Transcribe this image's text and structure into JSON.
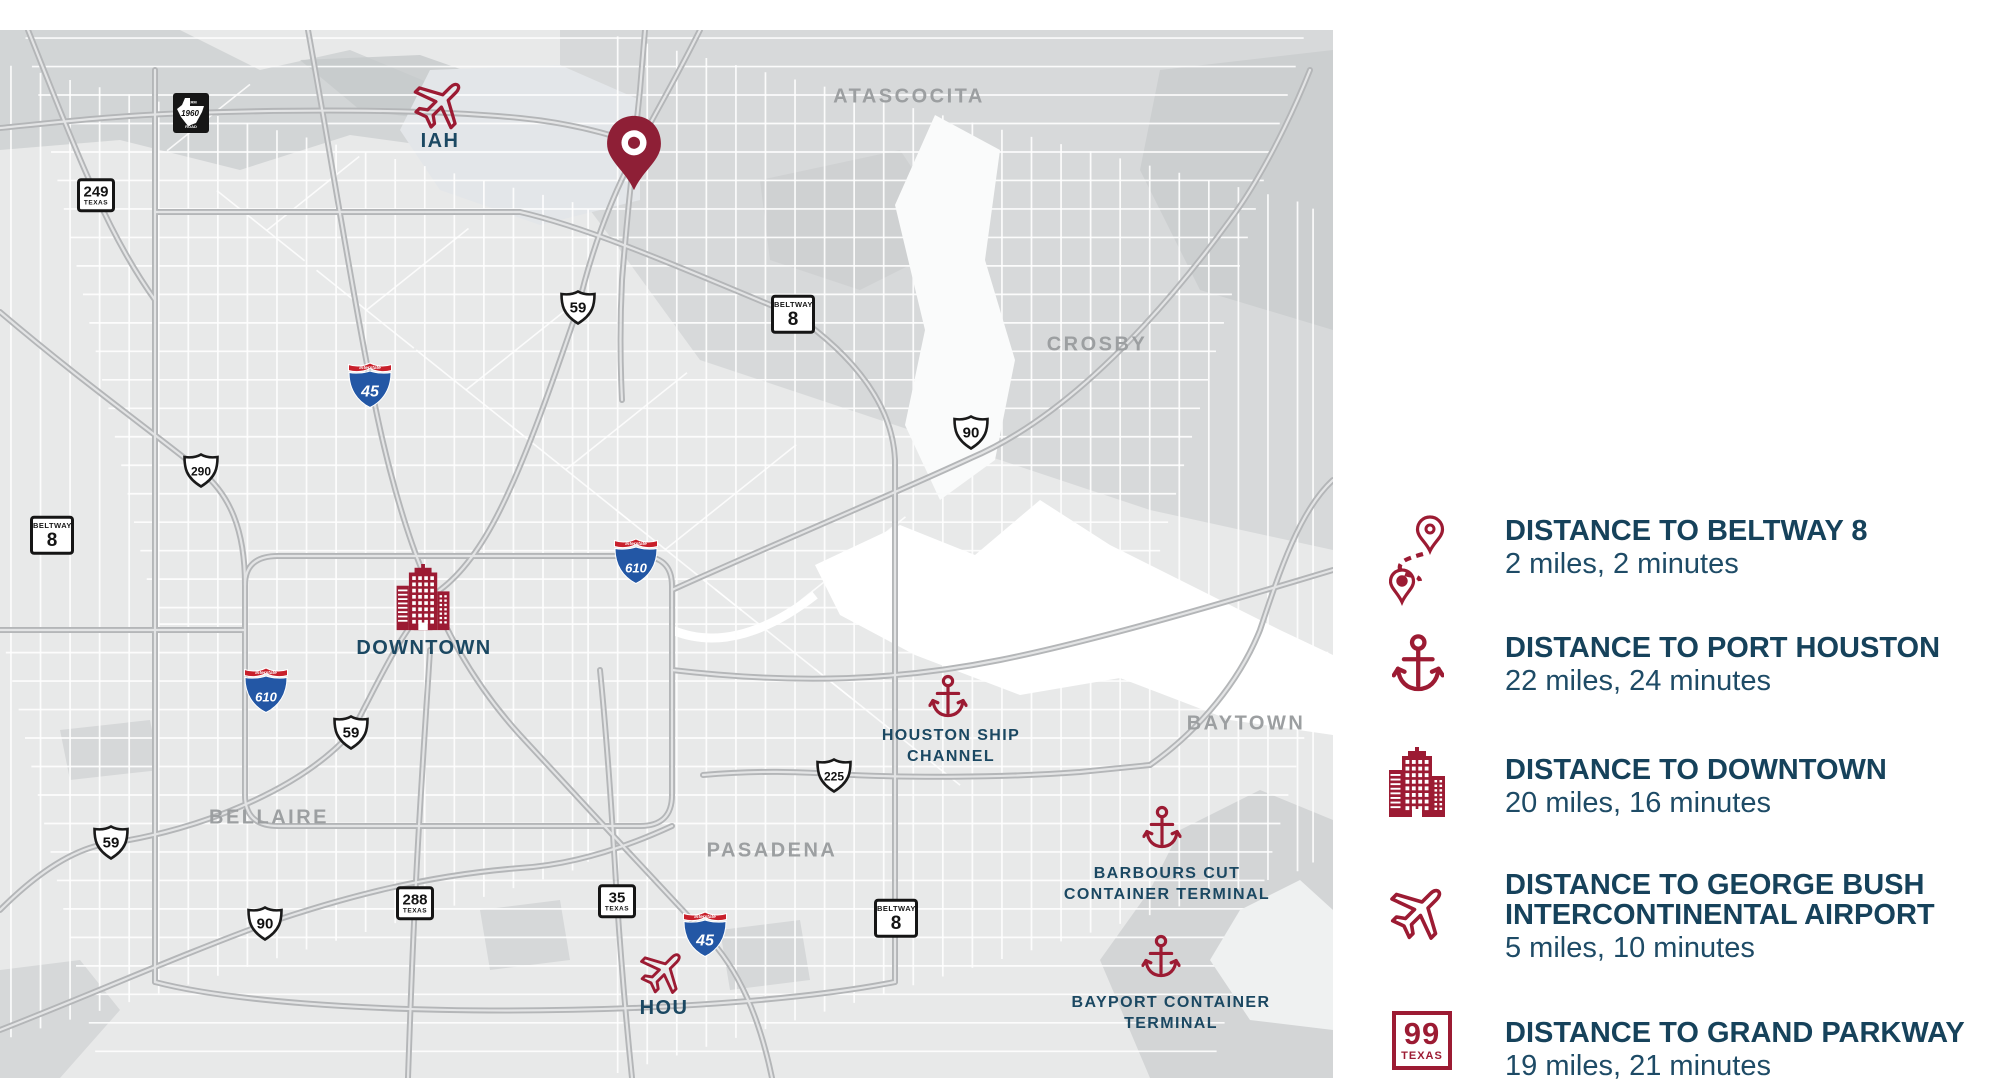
{
  "colors": {
    "brand_red": "#9c1b33",
    "pin_red": "#8e1f36",
    "heading_navy": "#16425b",
    "body_navy": "#1e4b66",
    "poi_navy": "#1b4862",
    "city_gray": "#9c9fa1",
    "interstate_blue": "#2357a5",
    "interstate_red": "#c8202b",
    "map_bg": "#e8e9e9"
  },
  "map": {
    "city_labels": [
      {
        "text": "ATASCOCITA",
        "x": 909,
        "y": 67
      },
      {
        "text": "CROSBY",
        "x": 1097,
        "y": 315
      },
      {
        "text": "BAYTOWN",
        "x": 1246,
        "y": 694
      },
      {
        "text": "BELLAIRE",
        "x": 269,
        "y": 788
      },
      {
        "text": "PASADENA",
        "x": 772,
        "y": 821
      }
    ],
    "poi_labels": [
      {
        "id": "iah-label",
        "lines": [
          "IAH"
        ],
        "x": 440,
        "y": 111,
        "size": 20
      },
      {
        "id": "downtown-label",
        "lines": [
          "DOWNTOWN"
        ],
        "x": 424,
        "y": 618,
        "size": 20
      },
      {
        "id": "hou-label",
        "lines": [
          "HOU"
        ],
        "x": 664,
        "y": 978,
        "size": 20
      },
      {
        "id": "houston-ship-channel-label",
        "lines": [
          "HOUSTON SHIP",
          "CHANNEL"
        ],
        "x": 951,
        "y": 716,
        "size": 16
      },
      {
        "id": "barbours-cut-label",
        "lines": [
          "BARBOURS CUT",
          "CONTAINER TERMINAL"
        ],
        "x": 1167,
        "y": 854,
        "size": 16
      },
      {
        "id": "bayport-label",
        "lines": [
          "BAYPORT CONTAINER",
          "TERMINAL"
        ],
        "x": 1171,
        "y": 983,
        "size": 16
      }
    ],
    "highway_shields": [
      {
        "type": "fm",
        "label": "1960",
        "x": 191,
        "y": 83
      },
      {
        "type": "tx",
        "label": "249",
        "sub": "TEXAS",
        "x": 96,
        "y": 165
      },
      {
        "type": "us",
        "label": "59",
        "x": 578,
        "y": 278
      },
      {
        "type": "beltway",
        "label": "8",
        "sub": "BELTWAY",
        "x": 793,
        "y": 284
      },
      {
        "type": "interstate",
        "label": "45",
        "x": 370,
        "y": 355
      },
      {
        "type": "us",
        "label": "290",
        "x": 201,
        "y": 441
      },
      {
        "type": "beltway",
        "label": "8",
        "sub": "BELTWAY",
        "x": 52,
        "y": 505
      },
      {
        "type": "interstate",
        "label": "610",
        "x": 636,
        "y": 531
      },
      {
        "type": "us",
        "label": "90",
        "x": 971,
        "y": 403
      },
      {
        "type": "interstate",
        "label": "610",
        "x": 266,
        "y": 660
      },
      {
        "type": "us",
        "label": "59",
        "x": 351,
        "y": 703
      },
      {
        "type": "us",
        "label": "59",
        "x": 111,
        "y": 813
      },
      {
        "type": "us",
        "label": "90",
        "x": 265,
        "y": 894
      },
      {
        "type": "tx",
        "label": "288",
        "sub": "TEXAS",
        "x": 415,
        "y": 873
      },
      {
        "type": "tx",
        "label": "35",
        "sub": "TEXAS",
        "x": 617,
        "y": 871
      },
      {
        "type": "interstate",
        "label": "45",
        "x": 705,
        "y": 904
      },
      {
        "type": "us",
        "label": "225",
        "x": 834,
        "y": 746
      },
      {
        "type": "beltway",
        "label": "8",
        "sub": "BELTWAY",
        "x": 896,
        "y": 888
      }
    ],
    "poi_icons": [
      {
        "type": "pin",
        "name": "property-location-pin-icon",
        "x": 634,
        "y": 123,
        "size": 78
      },
      {
        "type": "plane",
        "name": "iah-airport-icon",
        "x": 440,
        "y": 73,
        "size": 62
      },
      {
        "type": "plane",
        "name": "hou-airport-icon",
        "x": 663,
        "y": 941,
        "size": 54
      },
      {
        "type": "anchor",
        "name": "houston-ship-channel-anchor-icon",
        "x": 948,
        "y": 667,
        "size": 46
      },
      {
        "type": "anchor",
        "name": "barbours-cut-anchor-icon",
        "x": 1162,
        "y": 798,
        "size": 46
      },
      {
        "type": "anchor",
        "name": "bayport-anchor-icon",
        "x": 1161,
        "y": 927,
        "size": 46
      },
      {
        "type": "building",
        "name": "downtown-building-icon",
        "x": 424,
        "y": 568,
        "size": 68
      }
    ]
  },
  "legend": {
    "items": [
      {
        "id": "beltway8",
        "icon": "route",
        "title": "DISTANCE TO BELTWAY 8",
        "subtitle": "2 miles, 2 minutes",
        "text_top": 516,
        "icon_top": 514
      },
      {
        "id": "port-houston",
        "icon": "anchor",
        "title": "DISTANCE TO PORT HOUSTON",
        "subtitle": "22 miles, 24 minutes",
        "text_top": 633,
        "icon_top": 633
      },
      {
        "id": "downtown",
        "icon": "building",
        "title": "DISTANCE TO DOWNTOWN",
        "subtitle": "20 miles, 16 minutes",
        "text_top": 755,
        "icon_top": 747
      },
      {
        "id": "george-bush-airport",
        "icon": "plane",
        "title": "DISTANCE TO GEORGE BUSH INTERCONTINENTAL AIRPORT",
        "subtitle": "5 miles, 10 minutes",
        "text_top": 870,
        "icon_top": 877
      },
      {
        "id": "grand-parkway",
        "icon": "shield99",
        "title": "DISTANCE TO GRAND PARKWAY",
        "subtitle": "19 miles, 21 minutes",
        "text_top": 1018,
        "icon_top": 1011,
        "shield_num": "99",
        "shield_sub": "TEXAS"
      }
    ]
  }
}
